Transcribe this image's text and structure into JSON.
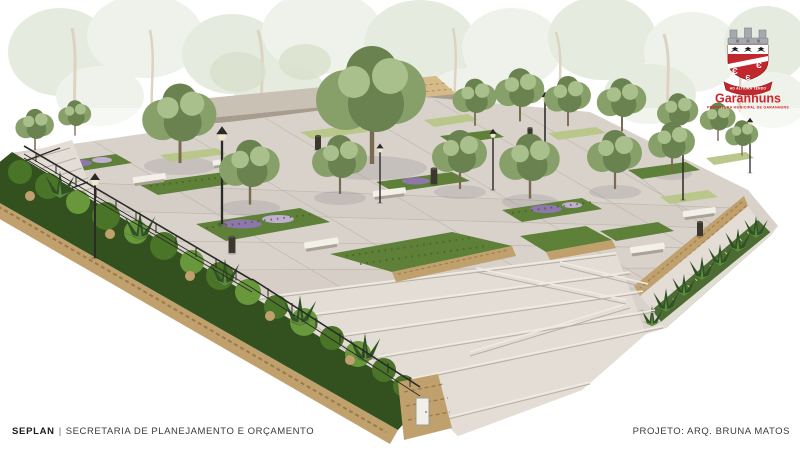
{
  "logo": {
    "city_name": "Garanhuns",
    "motto": "AD ALTIORA TENDO",
    "tagline": "PREFEITURA MUNICIPAL DE GARANHUNS",
    "shield_symbol": "Є"
  },
  "footer": {
    "department_abbr": "SEPLAN",
    "separator": "|",
    "department_name": "SECRETARIA DE PLANEJAMENTO E ORÇAMENTO",
    "project_credit": "PROJETO: ARQ. BRUNA MATOS"
  },
  "scene": {
    "description": "Aerial 3D architectural rendering of a landscaped public plaza: large concrete pavers, green planting beds with purple flowers, white concrete benches, black lamp posts and bins, stone retaining walls, a hedge-lined edge with metal railing, wide stairs and ramps in the foreground, and a flat-roofed stone pavilion surrounded by trees with faded woodland in the background."
  },
  "colors": {
    "paving": "#d8d2cb",
    "pavingLight": "#e3ddd5",
    "pavingShadow": "#b7aea4",
    "joint": "#bdb4aa",
    "stone": "#c0a06c",
    "stoneDark": "#92713f",
    "stoneLight": "#d6ba8a",
    "hedgeDark": "#33501f",
    "hedgeMid": "#4a7427",
    "hedgeLight": "#68973c",
    "treeDark": "#6a8150",
    "treeMid": "#87a06a",
    "treeLight": "#a9bf8c",
    "trunk": "#7b6a52",
    "fadedTree": "#e6ebdf",
    "fadedTree2": "#eff2ea",
    "fadedTrunk": "#ddd3c2",
    "grass": "#b9c78b",
    "bedGreen": "#5e8038",
    "flowerPurple": "#8f76ad",
    "flowerLight": "#c3aed3",
    "bench": "#f3f0ea",
    "benchShadow": "#aaa296",
    "metal": "#2a2a28",
    "lampGlass": "#efe6cc",
    "roof": "#c9c1b4",
    "roofEdge": "#a79d8e",
    "buildingDark": "#372f26",
    "buildingDeep": "#221d17",
    "buildingCol": "#958a79",
    "logoRed": "#c1272d",
    "logoRedBright": "#d2232a",
    "crownGray": "#a6a9ad",
    "crownDark": "#7c8085",
    "footerInk": "#1b1b19",
    "footerGray": "#3a3a38"
  }
}
